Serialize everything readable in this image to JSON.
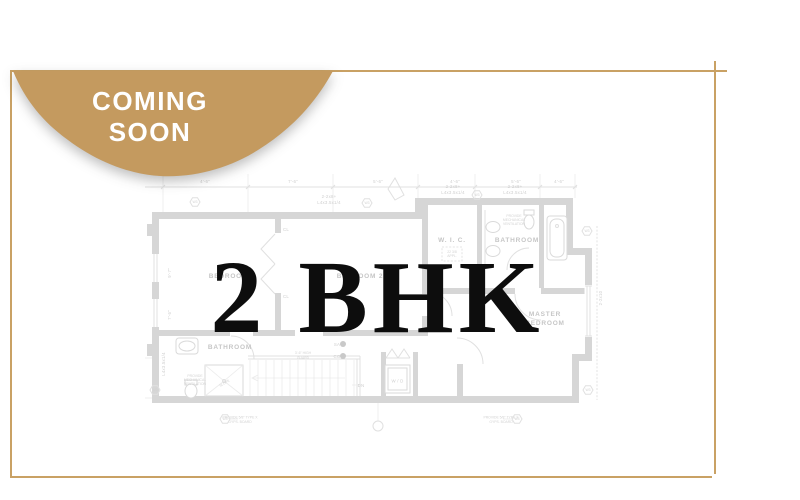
{
  "card": {
    "background": "#ffffff"
  },
  "frame": {
    "color": "#c9a164"
  },
  "badge": {
    "color": "#c49a5f",
    "text_color": "#ffffff",
    "line1": "COMING",
    "line2": "SOON"
  },
  "title": {
    "text": "2 BHK",
    "color": "#0d0d0d"
  },
  "floor_plan": {
    "wall_color": "#d6d6d6",
    "label_color": "#c6c6c6",
    "rooms": {
      "bedroom3": "BEDROOM 3",
      "bedroom2": "BEDROOM 2",
      "wic": "W. I. C.",
      "bathroom_top": "BATHROOM",
      "bathroom_bottom": "BATHROOM",
      "master1": "MASTER",
      "master2": "BEDROOM",
      "wd": "W / D",
      "cl": "CL",
      "slope": "SLOPE"
    },
    "annotations": {
      "lumber1": "2-2x8+",
      "lumber2": "L4x3.5x1/4",
      "gyps1": "PROVIDE 5/8\" TYPE X",
      "gyps2": "GYPS. BOARD",
      "vent1": "PROVIDE",
      "vent2": "MECHANICAL",
      "vent3": "VENTILATION",
      "guard1": "3'-6\" HIGH",
      "guard2": "GUARD",
      "sa": "SA",
      "co": "CO",
      "dn": "DN",
      "w3": "W3",
      "right_dim": "2-2x10",
      "appl1": "22 3/8",
      "appl2": "APPL."
    },
    "dims_top": [
      "4'-6\"",
      "7'-6\"",
      "5'-6\"",
      "4'-6\"",
      "5'-6\"",
      "4'-6\""
    ],
    "dims_left": [
      "9'-7\"",
      "7'-6\""
    ]
  }
}
